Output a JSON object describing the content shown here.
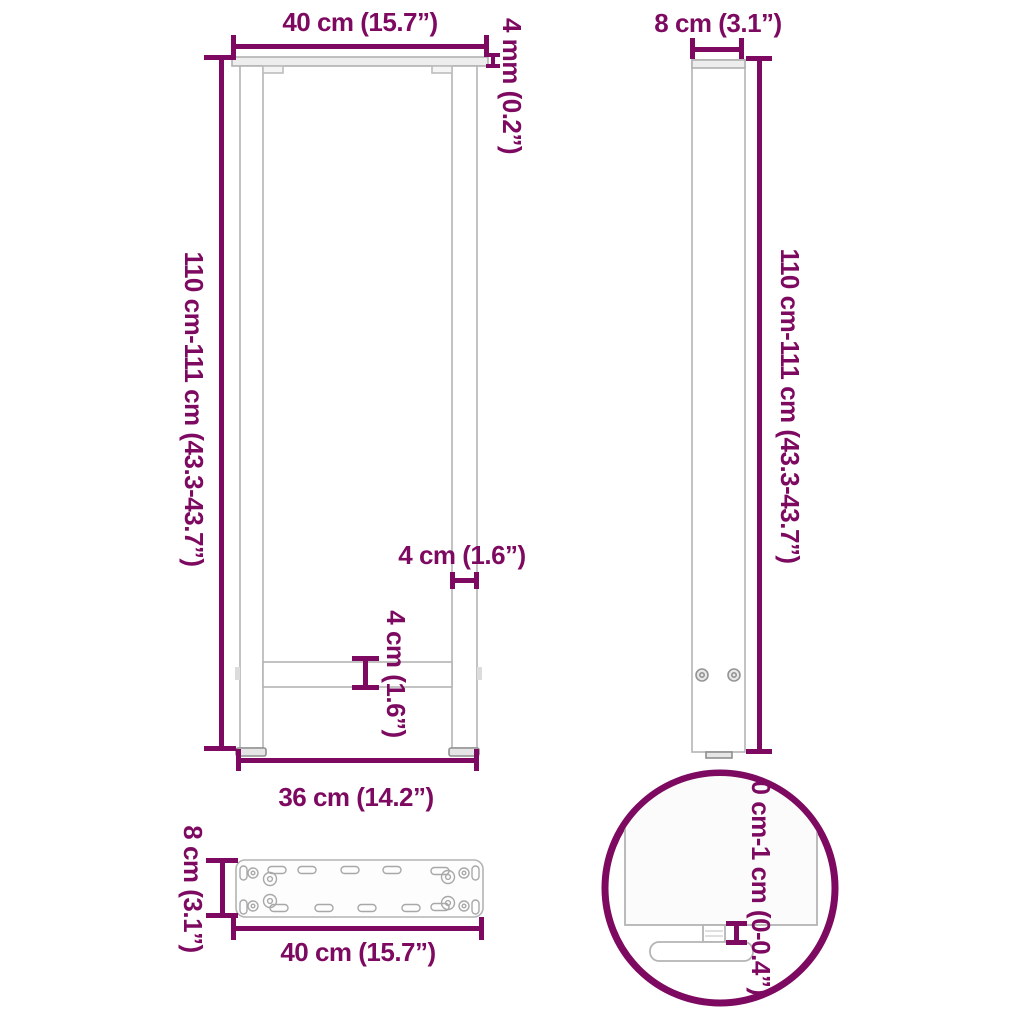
{
  "image_type": "product-dimension-diagram",
  "subject": "table-leg-frame",
  "colors": {
    "dimension_accent": "#7d0a60",
    "outline_gray": "#b4b4b4",
    "background": "#ffffff"
  },
  "views": {
    "front": {
      "title": "front-view",
      "width_top": "40 cm (15.7”)",
      "plate_thickness": "4 mm (0.2”)",
      "height": "110 cm-111 cm (43.3-43.7”)",
      "leg_width": "4 cm (1.6”)",
      "crossbar_height": "4 cm (1.6”)",
      "width_bottom": "36 cm (14.2”)"
    },
    "side": {
      "title": "side-view",
      "depth": "8 cm (3.1”)",
      "height": "110 cm-111 cm (43.3-43.7”)"
    },
    "plate": {
      "title": "mounting-plate-top-view",
      "depth": "8 cm (3.1”)",
      "width": "40 cm (15.7”)"
    },
    "detail": {
      "title": "adjustable-foot-detail",
      "foot_adjustment": "0 cm-1 cm (0-0.4”)"
    }
  }
}
